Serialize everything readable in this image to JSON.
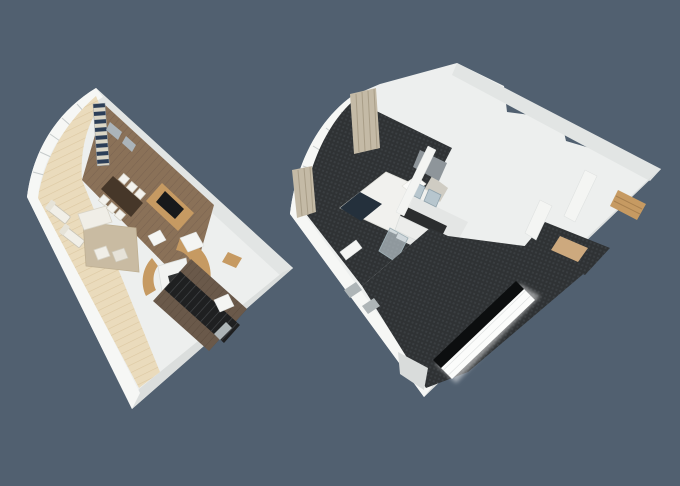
{
  "scene": {
    "type": "3d-dollhouse-floorplan-render",
    "description": "Two isometric cutaway 3D floor plans of a two-level suite on a slate background",
    "plans": [
      {
        "id": "living-level",
        "label": "living-deck-level-floorplan",
        "rooms": [
          "balcony-deck",
          "living-dining-room",
          "guest-bathroom",
          "stair-corridor"
        ],
        "furniture": [
          "sun-loungers",
          "dining-table",
          "dining-chairs",
          "striped-curtain",
          "tv-cabinet",
          "sofa",
          "coffee-table",
          "area-rug",
          "vanity",
          "staircase"
        ]
      },
      {
        "id": "bedroom-level",
        "label": "bedroom-level-floorplan",
        "rooms": [
          "bedroom",
          "en-suite-bathroom",
          "walk-in-closet",
          "stair-corridor"
        ],
        "furniture": [
          "bed",
          "pillows",
          "curtains",
          "double-vanity",
          "mirrors",
          "shower",
          "toilet",
          "closet-shelves",
          "staircase",
          "glass-balustrade"
        ]
      }
    ]
  },
  "colors": {
    "bg": "#516070",
    "wall": "#EDEFEE",
    "wallBright": "#F6F7F5",
    "wallShade": "#E2E5E4",
    "wallShade2": "#DBDEDD",
    "mullion": "#C6CBCB",
    "deck": "#EADBBC",
    "deckLine": "#DCC8A2",
    "wood": "#8A7158",
    "woodLine": "#7A6350",
    "rug": "#C9BBA2",
    "walnut": "#463729",
    "oak": "#C69A62",
    "oakDark": "#A8804F",
    "corridorWood": "#6A594A",
    "corridorLine": "#5C4C3E",
    "carpet": "#2F3234",
    "carpetWeave": "#3A3E41",
    "navy": "#24303C",
    "stripeNavy": "#2C3E57",
    "stripeCream": "#DBD6C6",
    "duvet": "#F1F1EE",
    "taupe": "#C4BAA6",
    "taupeLine": "#A99E88",
    "mirror": "#B7C6CE",
    "mosaic": "#8E959A",
    "counter": "#2B2D2E",
    "glassDark": "#0C0E0F",
    "stairDark": "#1F2021",
    "stairDarkLine": "#45484A",
    "glow": "#FFFFFF",
    "panel": "#AEB5B7"
  }
}
